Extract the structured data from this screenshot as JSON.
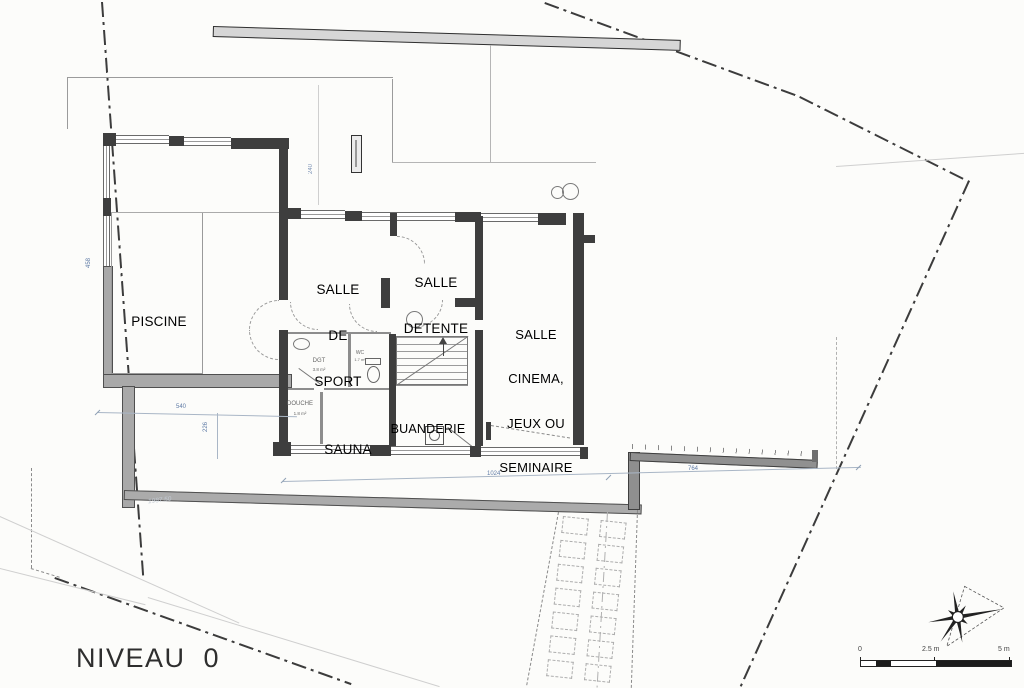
{
  "plan": {
    "level_label": "NIVEAU  0",
    "rooms": {
      "piscine": {
        "label": "PISCINE"
      },
      "sport": {
        "lines": [
          "SALLE",
          "DE",
          "SPORT"
        ]
      },
      "detente": {
        "lines": [
          "SALLE",
          "DETENTE"
        ]
      },
      "cinema": {
        "lines": [
          "SALLE",
          "CINEMA,",
          "JEUX OU",
          "SEMINAIRE"
        ]
      },
      "buanderie": {
        "label": "BUANDERIE"
      },
      "sauna": {
        "label": "SAUNA"
      },
      "douche": {
        "label": "DOUCHE",
        "area": "1.8 m²"
      },
      "degagement": {
        "label": "DGT",
        "area": "3.8 m²"
      },
      "wc": {
        "label": "WC",
        "area": "1.7 m²"
      }
    },
    "dimensions": {
      "building_width": "1024",
      "right_wall": "764",
      "left_terrace": "540",
      "left_offset": "226",
      "piscine_side": "458",
      "terrace_depth": "240"
    },
    "annotations": {
      "elevation_note": "1987.50"
    },
    "scale_bar": {
      "zero": "0",
      "mid": "2.5 m",
      "max": "5 m"
    },
    "colors": {
      "wall_dark": "#3e3e3e",
      "wall_gray": "#a9a9a9",
      "dimension_text": "#5f7ba6",
      "label_text": "#000000"
    }
  }
}
